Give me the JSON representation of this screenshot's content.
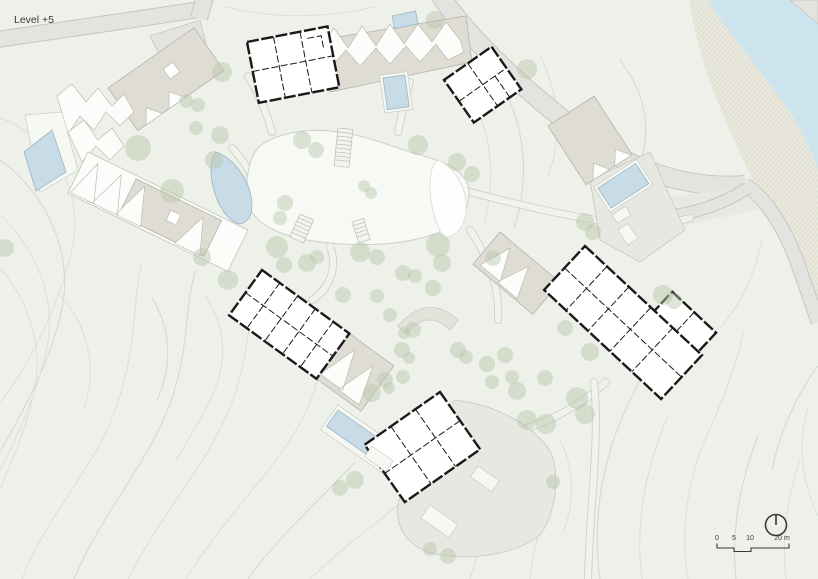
{
  "title": {
    "level_label": "Level +5"
  },
  "scale_bar": {
    "labels": [
      "0",
      "5",
      "10",
      "20 m"
    ],
    "ticks_m": [
      0,
      5,
      10,
      20
    ],
    "units": "m"
  },
  "compass": {
    "icon": "north-arrow-icon"
  },
  "palette": {
    "background": "#edf1ea",
    "contour": "#dbe0d4",
    "contour2": "#d3d9cb",
    "road_fill": "#e4e3df",
    "road_edge": "#c7c6c1",
    "water": "#cde4ee",
    "pool": "#c8dce8",
    "pool_edge": "#9db4c0",
    "tree": "#b8c4a8",
    "roof": "#dedcd3",
    "roof_edge": "#b4b3ac",
    "terrace": "#e6e8e1",
    "plan_wall": "#191919",
    "text": "#3a3a3a"
  },
  "trees": [
    [
      222,
      72,
      10
    ],
    [
      435,
      20,
      9
    ],
    [
      527,
      69,
      10
    ],
    [
      186,
      101,
      7
    ],
    [
      198,
      105,
      7
    ],
    [
      138,
      148,
      13
    ],
    [
      214,
      160,
      9
    ],
    [
      172,
      191,
      12
    ],
    [
      5,
      248,
      9
    ],
    [
      196,
      128,
      7
    ],
    [
      220,
      135,
      9
    ],
    [
      302,
      140,
      9
    ],
    [
      316,
      150,
      8
    ],
    [
      364,
      186,
      6
    ],
    [
      371,
      193,
      6
    ],
    [
      285,
      203,
      8
    ],
    [
      280,
      218,
      7
    ],
    [
      202,
      257,
      9
    ],
    [
      418,
      145,
      10
    ],
    [
      457,
      162,
      9
    ],
    [
      472,
      174,
      8
    ],
    [
      277,
      247,
      11
    ],
    [
      284,
      265,
      8
    ],
    [
      307,
      263,
      9
    ],
    [
      317,
      257,
      7
    ],
    [
      360,
      252,
      10
    ],
    [
      377,
      257,
      8
    ],
    [
      438,
      245,
      12
    ],
    [
      442,
      263,
      9
    ],
    [
      403,
      273,
      8
    ],
    [
      415,
      276,
      7
    ],
    [
      433,
      288,
      8
    ],
    [
      228,
      280,
      10
    ],
    [
      343,
      295,
      8
    ],
    [
      377,
      296,
      7
    ],
    [
      390,
      315,
      7
    ],
    [
      413,
      330,
      8
    ],
    [
      404,
      333,
      6
    ],
    [
      402,
      350,
      8
    ],
    [
      409,
      358,
      6
    ],
    [
      458,
      350,
      8
    ],
    [
      466,
      357,
      7
    ],
    [
      487,
      364,
      8
    ],
    [
      385,
      380,
      8
    ],
    [
      403,
      377,
      7
    ],
    [
      389,
      388,
      6
    ],
    [
      492,
      382,
      7
    ],
    [
      512,
      377,
      7
    ],
    [
      517,
      391,
      9
    ],
    [
      527,
      420,
      10
    ],
    [
      546,
      424,
      10
    ],
    [
      577,
      398,
      11
    ],
    [
      585,
      414,
      10
    ],
    [
      565,
      328,
      8
    ],
    [
      590,
      352,
      9
    ],
    [
      505,
      355,
      8
    ],
    [
      545,
      378,
      8
    ],
    [
      585,
      222,
      9
    ],
    [
      593,
      232,
      8
    ],
    [
      663,
      295,
      10
    ],
    [
      674,
      301,
      8
    ],
    [
      493,
      258,
      8
    ],
    [
      372,
      393,
      9
    ],
    [
      355,
      480,
      9
    ],
    [
      340,
      488,
      8
    ],
    [
      553,
      482,
      7
    ],
    [
      448,
      556,
      8
    ],
    [
      430,
      549,
      7
    ]
  ]
}
